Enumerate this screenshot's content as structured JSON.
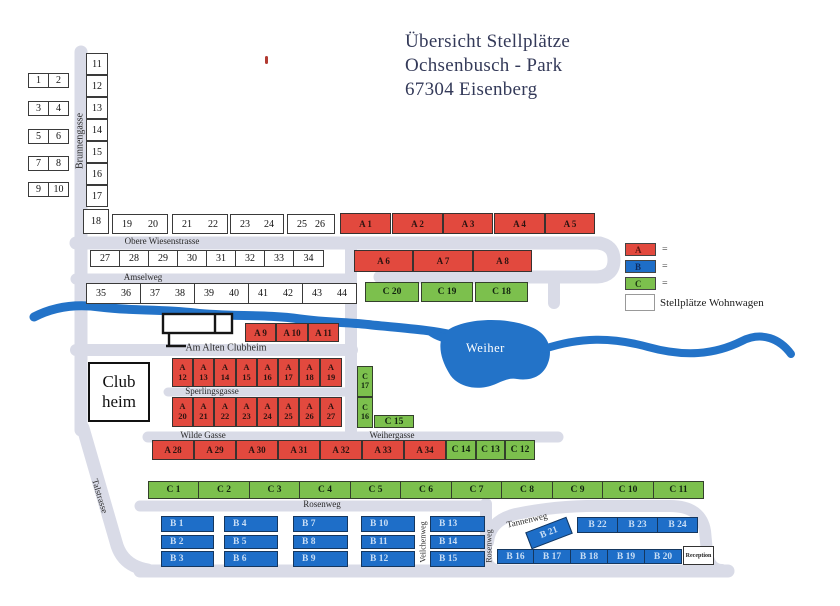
{
  "title": {
    "line1": "Übersicht  Stellplätze",
    "line2": "Ochsenbusch - Park",
    "line3": "67304 Eisenberg"
  },
  "legend": {
    "items": [
      {
        "label": "A",
        "color": "#e2493e",
        "letter_color": "#5c1511",
        "suffix": "="
      },
      {
        "label": "B",
        "color": "#1e6ec8",
        "letter_color": "#0e2b5e",
        "suffix": "="
      },
      {
        "label": "C",
        "color": "#7cc04d",
        "letter_color": "#1c3a12",
        "suffix": "="
      }
    ],
    "white_label": "Stellplätze Wohnwagen"
  },
  "landmarks": {
    "clubhouse_line1": "Club",
    "clubhouse_line2": "heim",
    "lake": "Weiher",
    "reception": "Reception"
  },
  "colors": {
    "plot_a": "#e2493e",
    "plot_b": "#1e6ec8",
    "plot_c": "#7cc04d",
    "river": "#2373c8",
    "road": "#d9dbe7"
  },
  "streets": [
    {
      "name": "brunnengasse",
      "label": "Brunnengasse",
      "x": 80,
      "y": 141,
      "rot": -90,
      "fs": 10
    },
    {
      "name": "obere-wiesenstrasse",
      "label": "Obere Wiesenstrasse",
      "x": 162,
      "y": 241,
      "rot": 0,
      "fs": 9
    },
    {
      "name": "amselweg",
      "label": "Amselweg",
      "x": 143,
      "y": 277,
      "rot": 0,
      "fs": 9
    },
    {
      "name": "am-alten-clubheim",
      "label": "Am Alten Clubheim",
      "x": 226,
      "y": 348,
      "rot": 0,
      "fs": 10
    },
    {
      "name": "sperlingsgasse",
      "label": "Sperlingsgasse",
      "x": 212,
      "y": 391,
      "rot": 0,
      "fs": 9
    },
    {
      "name": "wilde-gasse",
      "label": "Wilde Gasse",
      "x": 203,
      "y": 435,
      "rot": 0,
      "fs": 9
    },
    {
      "name": "weihergasse",
      "label": "Weihergasse",
      "x": 392,
      "y": 435,
      "rot": 0,
      "fs": 9
    },
    {
      "name": "rosenweg",
      "label": "Rosenweg",
      "x": 322,
      "y": 504,
      "rot": 0,
      "fs": 9
    },
    {
      "name": "rosenweg-vertical",
      "label": "Rosenweg",
      "x": 489,
      "y": 546,
      "rot": -90,
      "fs": 8
    },
    {
      "name": "veilchenweg",
      "label": "Veilchenweg",
      "x": 423,
      "y": 542,
      "rot": -90,
      "fs": 8
    },
    {
      "name": "tannenweg",
      "label": "Tannenweg",
      "x": 527,
      "y": 520,
      "rot": -13,
      "fs": 9
    },
    {
      "name": "talstrasse",
      "label": "Talstrasse",
      "x": 100,
      "y": 496,
      "rot": 73,
      "fs": 9
    }
  ],
  "plots": {
    "groups": [
      {
        "cls": "pw",
        "items": [
          {
            "t": "1",
            "x": 28,
            "y": 73,
            "w": 21,
            "h": 15
          },
          {
            "t": "2",
            "x": 48,
            "y": 73,
            "w": 21,
            "h": 15
          },
          {
            "t": "3",
            "x": 28,
            "y": 101,
            "w": 21,
            "h": 15
          },
          {
            "t": "4",
            "x": 48,
            "y": 101,
            "w": 21,
            "h": 15
          },
          {
            "t": "5",
            "x": 28,
            "y": 129,
            "w": 21,
            "h": 15
          },
          {
            "t": "6",
            "x": 48,
            "y": 129,
            "w": 21,
            "h": 15
          },
          {
            "t": "7",
            "x": 28,
            "y": 156,
            "w": 21,
            "h": 15
          },
          {
            "t": "8",
            "x": 48,
            "y": 156,
            "w": 21,
            "h": 15
          },
          {
            "t": "9",
            "x": 28,
            "y": 182,
            "w": 21,
            "h": 15
          },
          {
            "t": "10",
            "x": 48,
            "y": 182,
            "w": 21,
            "h": 15
          },
          {
            "t": "11",
            "x": 86,
            "y": 53,
            "w": 22,
            "h": 22
          },
          {
            "t": "12",
            "x": 86,
            "y": 75,
            "w": 22,
            "h": 22
          },
          {
            "t": "13",
            "x": 86,
            "y": 97,
            "w": 22,
            "h": 22
          },
          {
            "t": "14",
            "x": 86,
            "y": 119,
            "w": 22,
            "h": 22
          },
          {
            "t": "15",
            "x": 86,
            "y": 141,
            "w": 22,
            "h": 22
          },
          {
            "t": "16",
            "x": 86,
            "y": 163,
            "w": 22,
            "h": 22
          },
          {
            "t": "17",
            "x": 86,
            "y": 185,
            "w": 22,
            "h": 22
          },
          {
            "t": "18",
            "x": 83,
            "y": 209,
            "w": 26,
            "h": 25
          },
          {
            "t": "27",
            "x": 90,
            "y": 250,
            "w": 30,
            "h": 17
          },
          {
            "t": "28",
            "x": 119,
            "y": 250,
            "w": 30,
            "h": 17
          },
          {
            "t": "29",
            "x": 148,
            "y": 250,
            "w": 30,
            "h": 17
          },
          {
            "t": "30",
            "x": 177,
            "y": 250,
            "w": 30,
            "h": 17
          },
          {
            "t": "31",
            "x": 206,
            "y": 250,
            "w": 30,
            "h": 17
          },
          {
            "t": "32",
            "x": 235,
            "y": 250,
            "w": 30,
            "h": 17
          },
          {
            "t": "33",
            "x": 264,
            "y": 250,
            "w": 30,
            "h": 17
          },
          {
            "t": "34",
            "x": 293,
            "y": 250,
            "w": 31,
            "h": 17
          }
        ]
      },
      {
        "cls": "pp",
        "items": [
          {
            "a": "19",
            "b": "20",
            "x": 112,
            "y": 214,
            "w": 56,
            "h": 20
          },
          {
            "a": "21",
            "b": "22",
            "x": 172,
            "y": 214,
            "w": 56,
            "h": 20
          },
          {
            "a": "23",
            "b": "24",
            "x": 230,
            "y": 214,
            "w": 54,
            "h": 20
          },
          {
            "a": "25",
            "b": "26",
            "x": 287,
            "y": 214,
            "w": 48,
            "h": 20
          },
          {
            "a": "35",
            "b": "36",
            "x": 86,
            "y": 283,
            "w": 55,
            "h": 21
          },
          {
            "a": "37",
            "b": "38",
            "x": 140,
            "y": 283,
            "w": 55,
            "h": 21
          },
          {
            "a": "39",
            "b": "40",
            "x": 194,
            "y": 283,
            "w": 55,
            "h": 21
          },
          {
            "a": "41",
            "b": "42",
            "x": 248,
            "y": 283,
            "w": 55,
            "h": 21
          },
          {
            "a": "43",
            "b": "44",
            "x": 302,
            "y": 283,
            "w": 55,
            "h": 21
          }
        ]
      },
      {
        "cls": "pa",
        "items": [
          {
            "t": "A 1",
            "x": 340,
            "y": 213,
            "w": 51,
            "h": 21
          },
          {
            "t": "A 2",
            "x": 392,
            "y": 213,
            "w": 51,
            "h": 21
          },
          {
            "t": "A 3",
            "x": 443,
            "y": 213,
            "w": 50,
            "h": 21
          },
          {
            "t": "A 4",
            "x": 494,
            "y": 213,
            "w": 51,
            "h": 21
          },
          {
            "t": "A 5",
            "x": 545,
            "y": 213,
            "w": 50,
            "h": 21
          },
          {
            "t": "A 6",
            "x": 354,
            "y": 250,
            "w": 59,
            "h": 22
          },
          {
            "t": "A 7",
            "x": 413,
            "y": 250,
            "w": 60,
            "h": 22
          },
          {
            "t": "A 8",
            "x": 473,
            "y": 250,
            "w": 59,
            "h": 22
          },
          {
            "t": "A 9",
            "x": 245,
            "y": 323,
            "w": 31,
            "h": 19
          },
          {
            "t": "A 10",
            "x": 276,
            "y": 323,
            "w": 32,
            "h": 19
          },
          {
            "t": "A 11",
            "x": 308,
            "y": 323,
            "w": 31,
            "h": 19
          },
          {
            "t": "A 28",
            "x": 152,
            "y": 440,
            "w": 42,
            "h": 20
          },
          {
            "t": "A 29",
            "x": 194,
            "y": 440,
            "w": 42,
            "h": 20
          },
          {
            "t": "A 30",
            "x": 236,
            "y": 440,
            "w": 42,
            "h": 20
          },
          {
            "t": "A 31",
            "x": 278,
            "y": 440,
            "w": 42,
            "h": 20
          },
          {
            "t": "A 32",
            "x": 320,
            "y": 440,
            "w": 42,
            "h": 20
          },
          {
            "t": "A 33",
            "x": 362,
            "y": 440,
            "w": 42,
            "h": 20
          },
          {
            "t": "A 34",
            "x": 404,
            "y": 440,
            "w": 42,
            "h": 20
          }
        ]
      },
      {
        "cls": "pa pa2",
        "items": [
          {
            "t": "A|12",
            "x": 172,
            "y": 358,
            "w": 21,
            "h": 29
          },
          {
            "t": "A|13",
            "x": 193,
            "y": 358,
            "w": 21,
            "h": 29
          },
          {
            "t": "A|14",
            "x": 214,
            "y": 358,
            "w": 22,
            "h": 29
          },
          {
            "t": "A|15",
            "x": 236,
            "y": 358,
            "w": 21,
            "h": 29
          },
          {
            "t": "A|16",
            "x": 257,
            "y": 358,
            "w": 21,
            "h": 29
          },
          {
            "t": "A|17",
            "x": 278,
            "y": 358,
            "w": 21,
            "h": 29
          },
          {
            "t": "A|18",
            "x": 299,
            "y": 358,
            "w": 21,
            "h": 29
          },
          {
            "t": "A|19",
            "x": 320,
            "y": 358,
            "w": 22,
            "h": 29
          },
          {
            "t": "A|20",
            "x": 172,
            "y": 397,
            "w": 21,
            "h": 30
          },
          {
            "t": "A|21",
            "x": 193,
            "y": 397,
            "w": 21,
            "h": 30
          },
          {
            "t": "A|22",
            "x": 214,
            "y": 397,
            "w": 22,
            "h": 30
          },
          {
            "t": "A|23",
            "x": 236,
            "y": 397,
            "w": 21,
            "h": 30
          },
          {
            "t": "A|24",
            "x": 257,
            "y": 397,
            "w": 21,
            "h": 30
          },
          {
            "t": "A|25",
            "x": 278,
            "y": 397,
            "w": 21,
            "h": 30
          },
          {
            "t": "A|26",
            "x": 299,
            "y": 397,
            "w": 21,
            "h": 30
          },
          {
            "t": "A|27",
            "x": 320,
            "y": 397,
            "w": 22,
            "h": 30
          }
        ]
      },
      {
        "cls": "pc",
        "items": [
          {
            "t": "C 20",
            "x": 365,
            "y": 282,
            "w": 54,
            "h": 20
          },
          {
            "t": "C 19",
            "x": 421,
            "y": 282,
            "w": 52,
            "h": 20
          },
          {
            "t": "C 18",
            "x": 475,
            "y": 282,
            "w": 53,
            "h": 20
          },
          {
            "t": "C 15",
            "x": 374,
            "y": 415,
            "w": 40,
            "h": 13
          },
          {
            "t": "C 14",
            "x": 446,
            "y": 440,
            "w": 30,
            "h": 20
          },
          {
            "t": "C 13",
            "x": 476,
            "y": 440,
            "w": 29,
            "h": 20
          },
          {
            "t": "C 12",
            "x": 505,
            "y": 440,
            "w": 30,
            "h": 20
          },
          {
            "t": "C 1",
            "x": 148,
            "y": 481,
            "w": 51,
            "h": 18
          },
          {
            "t": "C 2",
            "x": 198,
            "y": 481,
            "w": 52,
            "h": 18
          },
          {
            "t": "C 3",
            "x": 249,
            "y": 481,
            "w": 51,
            "h": 18
          },
          {
            "t": "C 4",
            "x": 299,
            "y": 481,
            "w": 52,
            "h": 18
          },
          {
            "t": "C 5",
            "x": 350,
            "y": 481,
            "w": 51,
            "h": 18
          },
          {
            "t": "C 6",
            "x": 400,
            "y": 481,
            "w": 52,
            "h": 18
          },
          {
            "t": "C 7",
            "x": 451,
            "y": 481,
            "w": 51,
            "h": 18
          },
          {
            "t": "C 8",
            "x": 501,
            "y": 481,
            "w": 52,
            "h": 18
          },
          {
            "t": "C 9",
            "x": 552,
            "y": 481,
            "w": 51,
            "h": 18
          },
          {
            "t": "C 10",
            "x": 602,
            "y": 481,
            "w": 52,
            "h": 18
          },
          {
            "t": "C 11",
            "x": 653,
            "y": 481,
            "w": 51,
            "h": 18
          }
        ]
      },
      {
        "cls": "pc pc2",
        "items": [
          {
            "t": "C|17",
            "x": 357,
            "y": 366,
            "w": 16,
            "h": 31
          },
          {
            "t": "C|16",
            "x": 357,
            "y": 397,
            "w": 16,
            "h": 31
          }
        ]
      },
      {
        "cls": "pb pbl",
        "items": [
          {
            "t": "B 1",
            "x": 161,
            "y": 516,
            "w": 53,
            "h": 16
          },
          {
            "t": "B 2",
            "x": 161,
            "y": 535,
            "w": 53,
            "h": 14
          },
          {
            "t": "B 3",
            "x": 161,
            "y": 551,
            "w": 53,
            "h": 16
          },
          {
            "t": "B 4",
            "x": 224,
            "y": 516,
            "w": 54,
            "h": 16
          },
          {
            "t": "B 5",
            "x": 224,
            "y": 535,
            "w": 54,
            "h": 14
          },
          {
            "t": "B 6",
            "x": 224,
            "y": 551,
            "w": 54,
            "h": 16
          },
          {
            "t": "B 7",
            "x": 293,
            "y": 516,
            "w": 55,
            "h": 16
          },
          {
            "t": "B 8",
            "x": 293,
            "y": 535,
            "w": 55,
            "h": 14
          },
          {
            "t": "B 9",
            "x": 293,
            "y": 551,
            "w": 55,
            "h": 16
          },
          {
            "t": "B 10",
            "x": 361,
            "y": 516,
            "w": 54,
            "h": 16
          },
          {
            "t": "B 11",
            "x": 361,
            "y": 535,
            "w": 54,
            "h": 14
          },
          {
            "t": "B 12",
            "x": 361,
            "y": 551,
            "w": 54,
            "h": 16
          },
          {
            "t": "B 13",
            "x": 430,
            "y": 516,
            "w": 55,
            "h": 16
          },
          {
            "t": "B 14",
            "x": 430,
            "y": 535,
            "w": 55,
            "h": 14
          },
          {
            "t": "B 15",
            "x": 430,
            "y": 551,
            "w": 55,
            "h": 16
          }
        ]
      },
      {
        "cls": "pb",
        "items": [
          {
            "t": "B 16",
            "x": 497,
            "y": 549,
            "w": 37,
            "h": 15
          },
          {
            "t": "B 17",
            "x": 533,
            "y": 549,
            "w": 38,
            "h": 15
          },
          {
            "t": "B 18",
            "x": 570,
            "y": 549,
            "w": 38,
            "h": 15
          },
          {
            "t": "B 19",
            "x": 607,
            "y": 549,
            "w": 38,
            "h": 15
          },
          {
            "t": "B 20",
            "x": 644,
            "y": 549,
            "w": 38,
            "h": 15
          },
          {
            "t": "B 22",
            "x": 577,
            "y": 517,
            "w": 41,
            "h": 16
          },
          {
            "t": "B 23",
            "x": 617,
            "y": 517,
            "w": 41,
            "h": 16
          },
          {
            "t": "B 24",
            "x": 657,
            "y": 517,
            "w": 41,
            "h": 16
          },
          {
            "t": "B 21",
            "x": 527,
            "y": 524,
            "w": 44,
            "h": 18,
            "r": -21
          }
        ]
      }
    ]
  }
}
